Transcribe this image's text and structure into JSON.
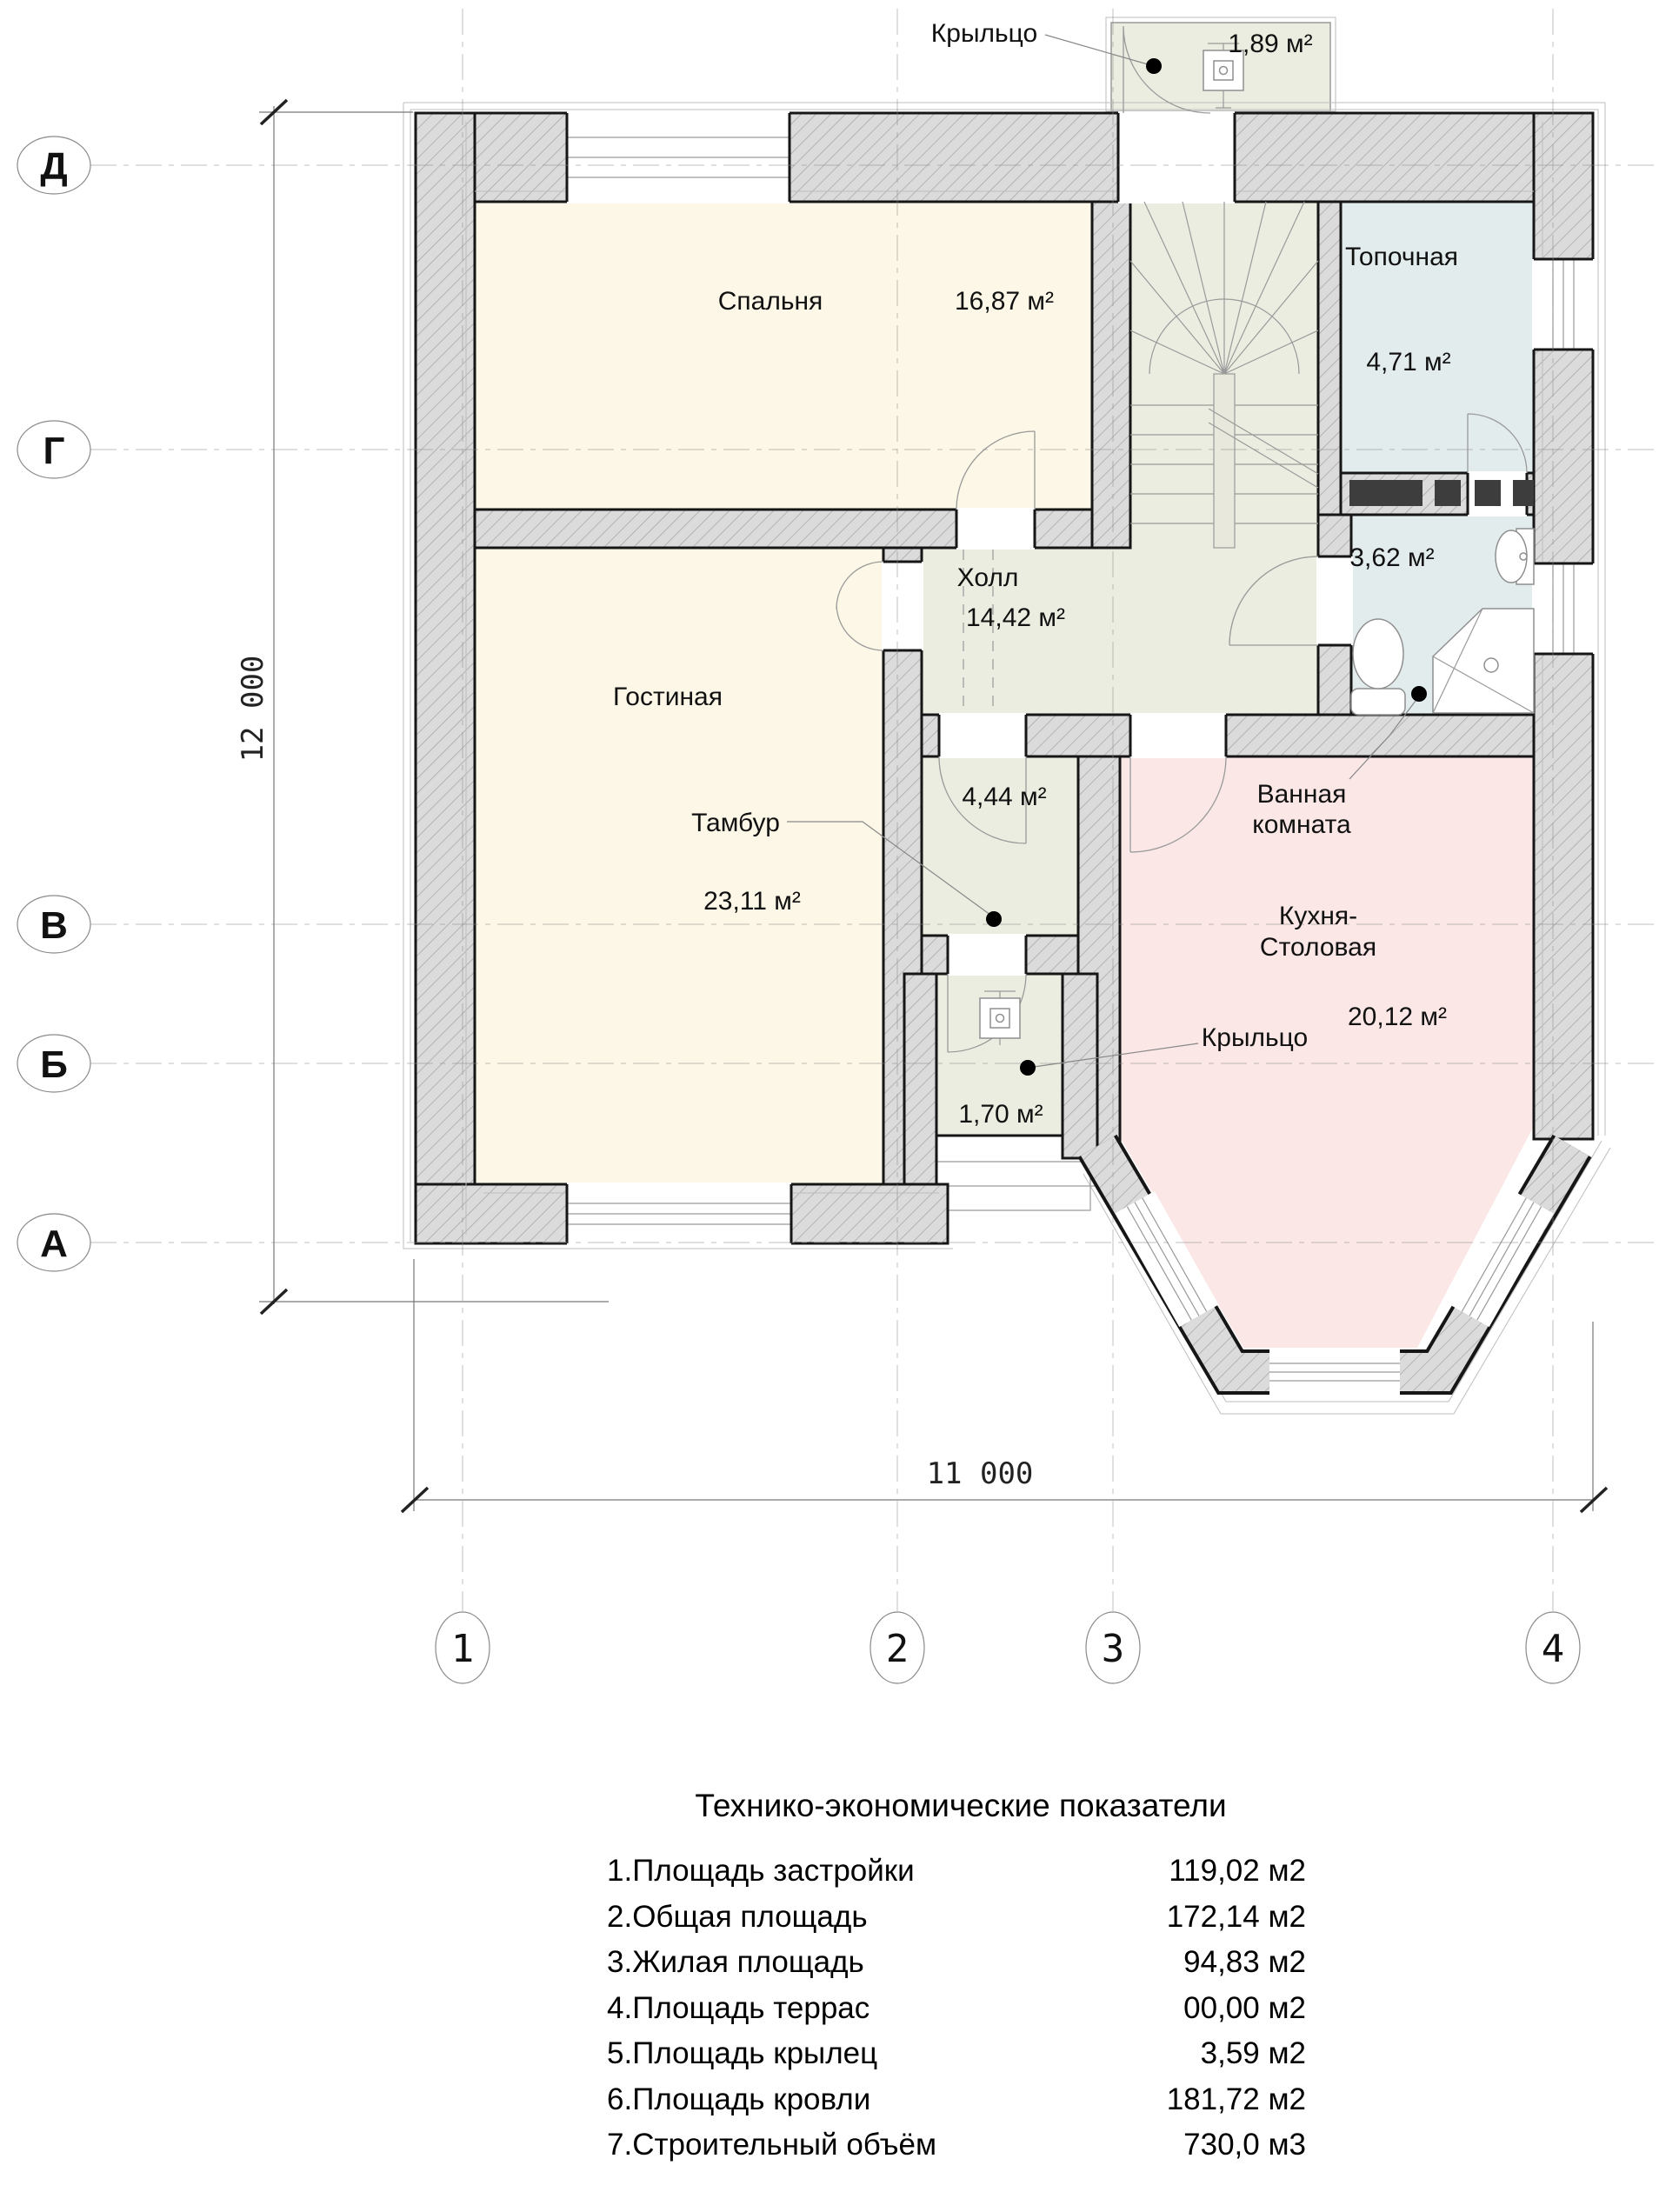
{
  "plan": {
    "rooms": {
      "bedroom": {
        "label": "Спальня",
        "area": "16,87 м²"
      },
      "boiler": {
        "label": "Топочная",
        "area": "4,71 м²"
      },
      "hall": {
        "label": "Холл",
        "area": "14,42 м²"
      },
      "living": {
        "label": "Гостиная",
        "area": "23,11 м²"
      },
      "tambour": {
        "label": "Тамбур",
        "area": "4,44 м²"
      },
      "bathroom": {
        "label_line1": "Ванная",
        "label_line2": "комната",
        "area": "3,62 м²"
      },
      "kitchen": {
        "label_line1": "Кухня-",
        "label_line2": "Столовая",
        "area": "20,12 м²"
      },
      "porch_top": {
        "label": "Крыльцо",
        "area": "1,89 м²"
      },
      "porch_bottom": {
        "label": "Крыльцо",
        "area": "1,70 м²"
      }
    },
    "axes": {
      "rows": [
        "Д",
        "Г",
        "В",
        "Б",
        "А"
      ],
      "cols": [
        "1",
        "2",
        "3",
        "4"
      ]
    },
    "dimensions": {
      "height": "12 000",
      "width": "11 000"
    },
    "colors": {
      "room_cream": "#FCF7E6",
      "room_service": "#ECEDE1",
      "room_wet": "#E2ECED",
      "room_kitchen": "#FAE7E6",
      "wall_fill": "#DBDBDB"
    }
  },
  "table": {
    "title": "Технико-экономические показатели",
    "rows": [
      {
        "label": "1.Площадь застройки",
        "value": "119,02 м2"
      },
      {
        "label": "2.Общая площадь",
        "value": "172,14 м2"
      },
      {
        "label": "3.Жилая площадь",
        "value": "94,83 м2"
      },
      {
        "label": "4.Площадь террас",
        "value": "00,00 м2"
      },
      {
        "label": "5.Площадь крылец",
        "value": "3,59 м2"
      },
      {
        "label": "6.Площадь кровли",
        "value": "181,72 м2"
      },
      {
        "label": "7.Строительный объём",
        "value": "730,0 м3"
      }
    ]
  }
}
